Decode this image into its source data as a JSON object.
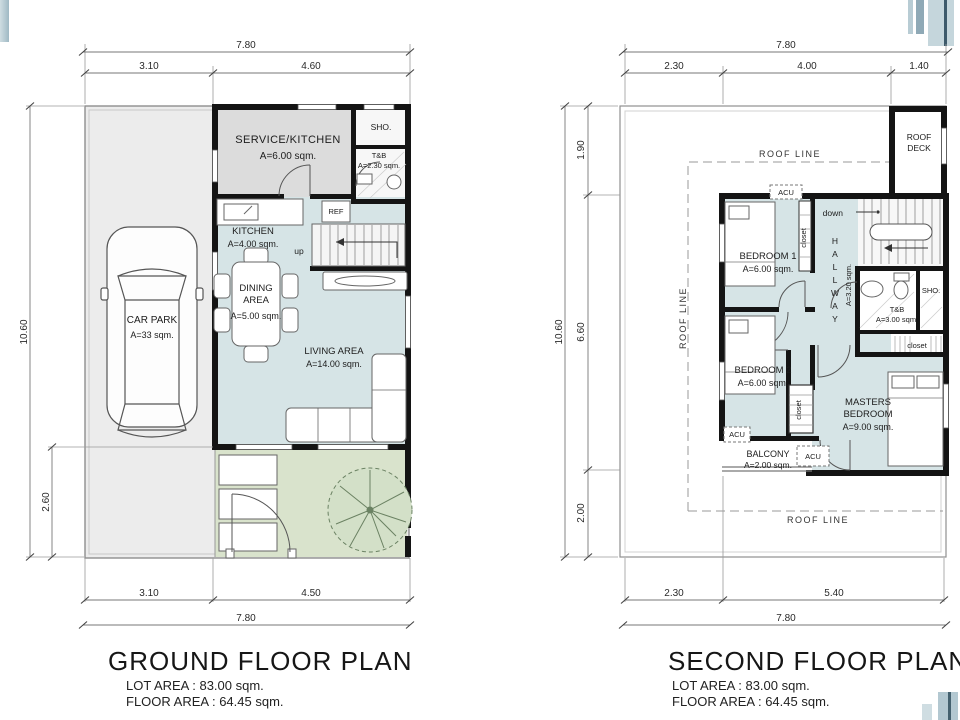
{
  "palette": {
    "interior_blue": "#d6e4e6",
    "service_gray": "#dcdcdc",
    "yard_gray": "#ececec",
    "garden_green": "#d9e3cc",
    "wall_black": "#141414",
    "accent_bar_light": "#c5d6dc",
    "accent_bar_mid": "#93abb8",
    "accent_bar_dark": "#3d5a6b"
  },
  "ground_plan": {
    "title": "GROUND FLOOR PLAN",
    "lot_area": "LOT AREA : 83.00 sqm.",
    "floor_area": "FLOOR AREA : 64.45 sqm.",
    "dims": {
      "top_total": "7.80",
      "top_left": "3.10",
      "top_right": "4.60",
      "side_total": "10.60",
      "side_garden": "2.60",
      "bottom_left": "3.10",
      "bottom_right": "4.50",
      "bottom_total": "7.80"
    },
    "rooms": {
      "service_kitchen": {
        "name": "SERVICE/KITCHEN",
        "area": "A=6.00 sqm."
      },
      "sho": "SHO.",
      "tb": {
        "name": "T&B",
        "area": "A=2.30 sqm."
      },
      "ref": "REF",
      "kitchen": {
        "name": "KITCHEN",
        "area": "A=4.00 sqm."
      },
      "up": "up",
      "dining": {
        "l1": "DINING",
        "l2": "AREA",
        "area": "A=5.00 sqm."
      },
      "living": {
        "name": "LIVING AREA",
        "area": "A=14.00 sqm."
      },
      "car_park": {
        "name": "CAR PARK",
        "area": "A=33 sqm."
      }
    }
  },
  "second_plan": {
    "title": "SECOND FLOOR PLAN",
    "lot_area": "LOT AREA : 83.00 sqm.",
    "floor_area": "FLOOR AREA : 64.45 sqm.",
    "dims": {
      "top_total": "7.80",
      "top_a": "2.30",
      "top_b": "4.00",
      "top_c": "1.40",
      "side_total": "10.60",
      "side_a": "1.90",
      "side_b": "6.60",
      "side_c": "2.00",
      "bottom_a": "2.30",
      "bottom_b": "5.40",
      "bottom_total": "7.80"
    },
    "labels": {
      "roof_line": "ROOF LINE",
      "roof_deck": {
        "l1": "ROOF",
        "l2": "DECK"
      },
      "down": "down",
      "bedroom1": {
        "name": "BEDROOM 1",
        "area": "A=6.00 sqm."
      },
      "bedroom2": {
        "name": "BEDROOM 2",
        "area": "A=6.00 sqm."
      },
      "masters": {
        "l1": "MASTERS",
        "l2": "BEDROOM",
        "area": "A=9.00 sqm."
      },
      "hallway": {
        "name": "HALLWAY",
        "area": "A=3.20 sqm."
      },
      "tb": {
        "name": "T&B",
        "area": "A=3.00 sqm."
      },
      "sho": "SHO.",
      "closet": "closet",
      "balcony": {
        "name": "BALCONY",
        "area": "A=2.00 sqm."
      },
      "acu": "ACU"
    }
  }
}
